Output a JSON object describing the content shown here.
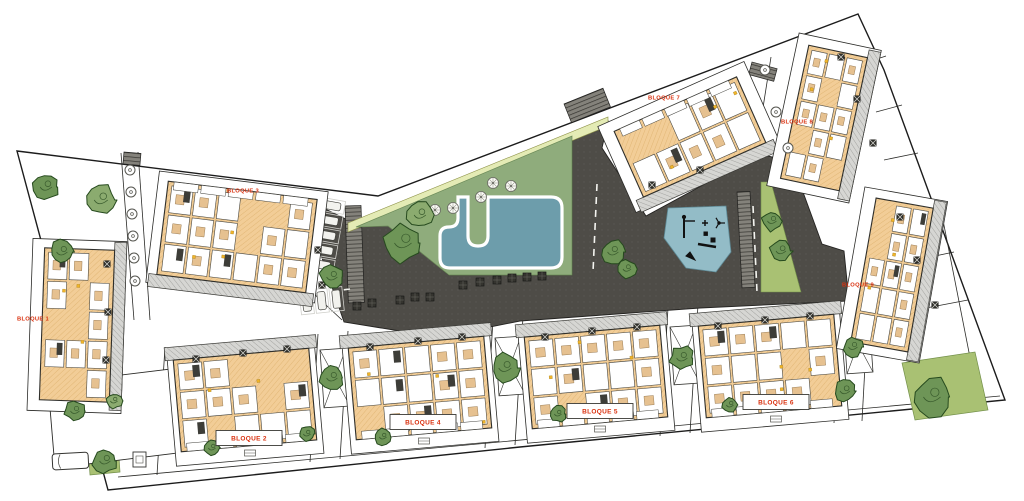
{
  "plan": {
    "type": "residential-site-plan",
    "colors": {
      "paving": "#4e4c47",
      "paving_dot": "#5a5853",
      "lawn": "#8fac7c",
      "path_band": "#e4ebb5",
      "pool_water": "#6d9dab",
      "playground": "#93bcc7",
      "green_strip": "#a9c173",
      "building_fill": "#f2cd97",
      "building_hatch": "#ddb06c",
      "roof_strip": "#d6d6d3",
      "roof_hatch": "#a3a3a0",
      "wall": "#2f2f2b",
      "tree_dark": "#6e9557",
      "tree_light": "#8bab6f",
      "tree_outline": "#264a1e",
      "label_red": "#d9300e",
      "accent_yellow": "#f0b429",
      "boundary": "#1c1c1c"
    },
    "blocks": [
      {
        "id": 1,
        "label": "BLOQUE 1",
        "cx": 77,
        "cy": 325,
        "w": 70,
        "h": 152,
        "rot": 2,
        "strip": "right",
        "label_x": 33,
        "label_y": 318,
        "boxed": false,
        "plot": [
          30,
          240,
          94,
          172
        ],
        "markers": [
          [
            107,
            264
          ],
          [
            108,
            312
          ],
          [
            106,
            360
          ]
        ]
      },
      {
        "id": 2,
        "label": "BLOQUE 2",
        "cx": 245,
        "cy": 400,
        "w": 136,
        "h": 92,
        "rot": -5,
        "strip": "top",
        "label_x": 249,
        "label_y": 438,
        "boxed": true,
        "plot": [
          171,
          342,
          148,
          118
        ],
        "markers": [
          [
            196,
            359
          ],
          [
            243,
            353
          ],
          [
            287,
            349
          ]
        ]
      },
      {
        "id": 3,
        "label": "BLOQUE 3",
        "cx": 237,
        "cy": 237,
        "w": 150,
        "h": 94,
        "rot": 7,
        "strip": "bottom",
        "label_x": 243,
        "label_y": 190,
        "boxed": false,
        "plot": [
          152,
          181,
          170,
          112
        ],
        "markers": [
          [
            318,
            250
          ],
          [
            322,
            285
          ]
        ]
      },
      {
        "id": 4,
        "label": "BLOQUE 4",
        "cx": 420,
        "cy": 388,
        "w": 136,
        "h": 92,
        "rot": -5,
        "strip": "top",
        "label_x": 423,
        "label_y": 422,
        "boxed": true,
        "plot": [
          346,
          330,
          148,
          118
        ],
        "markers": [
          [
            370,
            347
          ],
          [
            418,
            341
          ],
          [
            462,
            337
          ]
        ]
      },
      {
        "id": 5,
        "label": "BLOQUE 5",
        "cx": 596,
        "cy": 377,
        "w": 136,
        "h": 92,
        "rot": -5,
        "strip": "top",
        "label_x": 600,
        "label_y": 411,
        "boxed": true,
        "plot": [
          522,
          319,
          148,
          118
        ],
        "markers": [
          [
            545,
            337
          ],
          [
            592,
            331
          ],
          [
            637,
            327
          ]
        ]
      },
      {
        "id": 6,
        "label": "BLOQUE 6",
        "cx": 770,
        "cy": 366,
        "w": 136,
        "h": 92,
        "rot": -5,
        "strip": "top",
        "label_x": 776,
        "label_y": 402,
        "boxed": true,
        "plot": [
          696,
          308,
          148,
          118
        ],
        "markers": [
          [
            718,
            326
          ],
          [
            765,
            320
          ],
          [
            810,
            316
          ]
        ]
      },
      {
        "id": 7,
        "label": "BLOQUE 7",
        "cx": 690,
        "cy": 137,
        "w": 134,
        "h": 72,
        "rot": -24,
        "strip": "bottom",
        "label_x": 664,
        "label_y": 97,
        "boxed": false,
        "plot": [
          610,
          90,
          160,
          94
        ],
        "markers": [
          [
            652,
            185
          ],
          [
            700,
            170
          ]
        ]
      },
      {
        "id": 8,
        "label": "BLOQUE 8",
        "cx": 824,
        "cy": 118,
        "w": 60,
        "h": 136,
        "rot": 12,
        "strip": "right",
        "label_x": 797,
        "label_y": 121,
        "boxed": false,
        "plot": [
          782,
          40,
          84,
          156
        ],
        "markers": [
          [
            841,
            57
          ],
          [
            857,
            99
          ],
          [
            873,
            143
          ]
        ]
      },
      {
        "id": 9,
        "label": "BLOQUE 9",
        "cx": 892,
        "cy": 275,
        "w": 58,
        "h": 146,
        "rot": 10,
        "strip": "right",
        "label_x": 858,
        "label_y": 284,
        "boxed": false,
        "plot": [
          850,
          193,
          84,
          164
        ],
        "markers": [
          [
            900,
            217
          ],
          [
            917,
            260
          ],
          [
            935,
            305
          ]
        ]
      }
    ],
    "areas": [
      {
        "name": "swimming-pool",
        "color": "#6d9dab"
      },
      {
        "name": "lawn",
        "color": "#8fac7c"
      },
      {
        "name": "playground",
        "color": "#93bcc7"
      },
      {
        "name": "paved-plaza",
        "color": "#4e4c47"
      },
      {
        "name": "perimeter-path",
        "color": "#e4ebb5"
      },
      {
        "name": "green-strip",
        "color": "#a9c173"
      },
      {
        "name": "green-patch-southeast",
        "color": "#a9c173"
      },
      {
        "name": "green-patch-southwest",
        "color": "#a9c173"
      }
    ],
    "boundary": [
      [
        17,
        151
      ],
      [
        378,
        196
      ],
      [
        858,
        14
      ],
      [
        884,
        70
      ],
      [
        950,
        250
      ],
      [
        1005,
        400
      ],
      [
        520,
        447
      ],
      [
        108,
        490
      ]
    ],
    "dark_plaza": [
      [
        301,
        197
      ],
      [
        356,
        224
      ],
      [
        390,
        226
      ],
      [
        449,
        275
      ],
      [
        572,
        275
      ],
      [
        572,
        136
      ],
      [
        608,
        121
      ],
      [
        602,
        148
      ],
      [
        646,
        216
      ],
      [
        760,
        154
      ],
      [
        792,
        162
      ],
      [
        822,
        244
      ],
      [
        844,
        251
      ],
      [
        849,
        301
      ],
      [
        700,
        308
      ],
      [
        520,
        321
      ],
      [
        460,
        333
      ],
      [
        400,
        331
      ],
      [
        344,
        322
      ]
    ],
    "band_quad": [
      [
        348,
        223
      ],
      [
        608,
        117
      ],
      [
        608,
        126
      ],
      [
        348,
        232
      ]
    ],
    "lawn_poly": [
      [
        356,
        227
      ],
      [
        572,
        136
      ],
      [
        572,
        275
      ],
      [
        449,
        275
      ],
      [
        388,
        226
      ]
    ],
    "pool_path": "M458,197 H468 V236 Q468,246 478,246 Q488,246 488,236 V197 H551 Q562,197 562,208 V257 Q562,268 551,268 H450 Q440,268 440,258 V236 Q440,227 449,227 Q458,227 458,218 Z",
    "playground_poly": [
      [
        668,
        208
      ],
      [
        726,
        206
      ],
      [
        731,
        252
      ],
      [
        716,
        272
      ],
      [
        686,
        268
      ],
      [
        664,
        238
      ]
    ],
    "green_strip_poly": [
      [
        761,
        182
      ],
      [
        771,
        182
      ],
      [
        801,
        292
      ],
      [
        761,
        292
      ]
    ],
    "gp_se": [
      [
        902,
        363
      ],
      [
        975,
        352
      ],
      [
        988,
        410
      ],
      [
        915,
        420
      ]
    ],
    "gp_sw": [
      [
        88,
        446
      ],
      [
        118,
        443
      ],
      [
        120,
        472
      ],
      [
        90,
        475
      ]
    ],
    "bottom_left_quad": [
      [
        48,
        384
      ],
      [
        228,
        362
      ],
      [
        235,
        446
      ],
      [
        55,
        468
      ]
    ],
    "car_spot": {
      "x": 52,
      "y": 454,
      "w": 36,
      "h": 16
    },
    "utility_box": [
      133,
      452,
      13,
      15
    ],
    "trees": [
      [
        46,
        187,
        13,
        0
      ],
      [
        101,
        200,
        15,
        1
      ],
      [
        62,
        252,
        12,
        0
      ],
      [
        403,
        243,
        19,
        0
      ],
      [
        420,
        215,
        13,
        1
      ],
      [
        332,
        277,
        12,
        0
      ],
      [
        613,
        252,
        12,
        0
      ],
      [
        627,
        269,
        9,
        0
      ],
      [
        932,
        397,
        19,
        0
      ],
      [
        845,
        391,
        11,
        0
      ],
      [
        505,
        368,
        14,
        0
      ],
      [
        332,
        378,
        12,
        0
      ],
      [
        682,
        358,
        12,
        0
      ],
      [
        853,
        347,
        10,
        0
      ],
      [
        772,
        221,
        10,
        0
      ],
      [
        781,
        251,
        11,
        0
      ],
      [
        105,
        461,
        12,
        0
      ],
      [
        75,
        411,
        10,
        0
      ],
      [
        114,
        401,
        8,
        1
      ],
      [
        212,
        448,
        8,
        0
      ],
      [
        307,
        434,
        8,
        0
      ],
      [
        383,
        437,
        8,
        0
      ],
      [
        558,
        414,
        8,
        0
      ],
      [
        730,
        405,
        8,
        0
      ]
    ],
    "road_trees": [
      [
        765,
        70
      ],
      [
        776,
        112
      ],
      [
        788,
        148
      ],
      [
        130,
        170
      ],
      [
        131,
        192
      ],
      [
        132,
        214
      ],
      [
        133,
        236
      ],
      [
        134,
        258
      ],
      [
        135,
        281
      ]
    ],
    "parasols": [
      [
        435,
        210
      ],
      [
        453,
        208
      ],
      [
        481,
        197
      ],
      [
        493,
        183
      ],
      [
        511,
        186
      ]
    ],
    "planters": [
      [
        400,
        300
      ],
      [
        415,
        297
      ],
      [
        430,
        297
      ],
      [
        372,
        303
      ],
      [
        463,
        285
      ],
      [
        480,
        282
      ],
      [
        497,
        280
      ],
      [
        512,
        278
      ],
      [
        527,
        277
      ],
      [
        542,
        276
      ],
      [
        357,
        306
      ]
    ],
    "crossings": [
      [
        345,
        206,
        16,
        97,
        -2
      ],
      [
        737,
        192,
        13,
        96,
        -3
      ],
      [
        564,
        104,
        42,
        20,
        -22
      ],
      [
        752,
        62,
        26,
        13,
        15
      ],
      [
        124,
        152,
        17,
        12,
        5
      ]
    ],
    "lines": [
      [
        756,
        152,
        771,
        57
      ],
      [
        788,
        150,
        802,
        59
      ],
      [
        940,
        205,
        977,
        393
      ],
      [
        118,
        477,
        1000,
        396
      ],
      [
        121,
        153,
        134,
        320
      ],
      [
        138,
        152,
        150,
        320
      ],
      [
        312,
        292,
        342,
        320
      ],
      [
        868,
        62,
        886,
        56
      ],
      [
        876,
        112,
        902,
        105
      ],
      [
        884,
        160,
        918,
        153
      ],
      [
        905,
        212,
        938,
        205
      ],
      [
        916,
        260,
        954,
        252
      ],
      [
        926,
        308,
        968,
        300
      ],
      [
        318,
        334,
        310,
        462
      ],
      [
        348,
        331,
        340,
        459
      ],
      [
        493,
        320,
        485,
        448
      ],
      [
        523,
        317,
        515,
        445
      ],
      [
        668,
        308,
        660,
        436
      ],
      [
        698,
        305,
        690,
        433
      ],
      [
        841,
        295,
        834,
        423
      ],
      [
        869,
        293,
        862,
        421
      ],
      [
        165,
        347,
        157,
        475
      ]
    ],
    "dashes": [
      [
        597,
        184,
        593,
        272
      ],
      [
        753,
        206,
        757,
        292
      ],
      [
        318,
        293,
        350,
        289
      ]
    ],
    "braces": [
      [
        320,
        350
      ],
      [
        495,
        338
      ],
      [
        670,
        327
      ],
      [
        843,
        316
      ]
    ],
    "canopies": [
      [
        250,
        453
      ],
      [
        424,
        441
      ],
      [
        600,
        429
      ],
      [
        776,
        419
      ]
    ],
    "playground_icons": [
      "swing-frame",
      "climber-cross",
      "roundabout",
      "sandbox",
      "see-saw",
      "slide-arrow"
    ],
    "stall_groups": [
      {
        "x": 320,
        "y": 197,
        "rot": 10,
        "n": 5,
        "dir": "h"
      },
      {
        "x": 299,
        "y": 291,
        "rot": -6,
        "n": 3,
        "dir": "v"
      }
    ]
  }
}
